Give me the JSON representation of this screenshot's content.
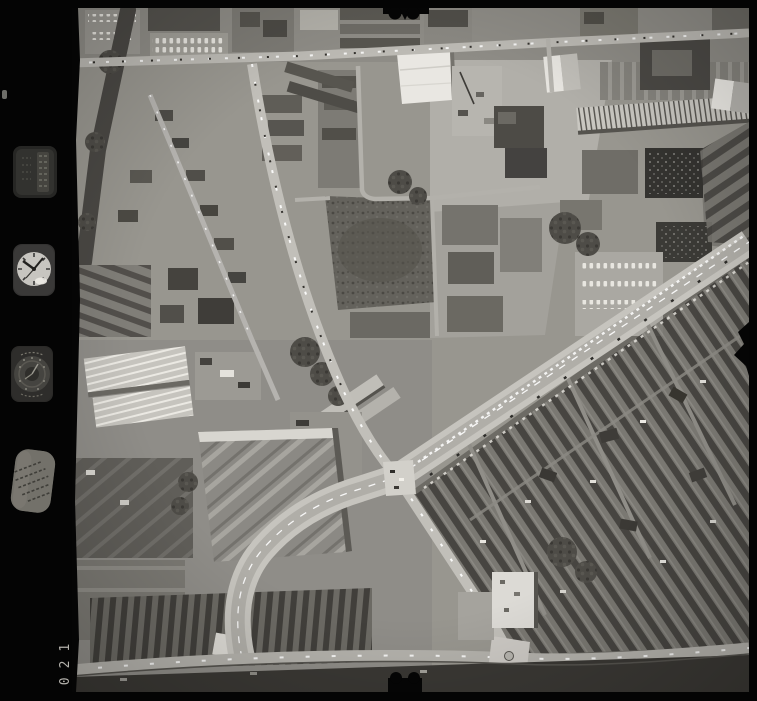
{
  "document": {
    "kind": "black-and-white vertical aerial survey photograph (film frame scan)",
    "frame_number": "021"
  },
  "film_margin": {
    "frame_number": "021",
    "instruments": [
      {
        "name": "data-plate-icon",
        "depicts": "small data plate with faint columns of text"
      },
      {
        "name": "clock-icon",
        "depicts": "mission clock dial, hands near 10:10"
      },
      {
        "name": "altimeter-icon",
        "depicts": "dark circular altimeter dial with ring markings"
      },
      {
        "name": "survey-stamp-icon",
        "depicts": "tilted oval plate with faint illegible stamped text"
      }
    ],
    "artifacts": [
      "fiducial notch top centre",
      "fiducial notch bottom centre",
      "black bite on right film edge",
      "small scratch on left margin"
    ]
  },
  "photo": {
    "scene": "urban area with a major staggered crossroads, terraced housing, factory sheds and cleared demolition ground",
    "features": [
      "high street running across the top with parked cars",
      "main road descending from top centre to central crossroads",
      "wide boulevard from crossroads to upper right edge lined with parked cars",
      "curved link road from crossroads down to bottom road",
      "bottom road across full width with vehicles",
      "large white-roofed building top centre",
      "white gabled factory buildings upper right",
      "long ridged factory sheds lower left",
      "dark waste ground centre",
      "dense terraced housing lower right",
      "white flat-roofed building near bottom junction"
    ],
    "colors": {
      "film_black": "#040404",
      "photo_midtone": "#98968f",
      "road_light": "#c6c4be",
      "roof_dark": "#45433f",
      "roof_white": "#e9e7e2",
      "tree_dark": "#4b4945",
      "frame_digits": "#b3b1ab"
    }
  }
}
